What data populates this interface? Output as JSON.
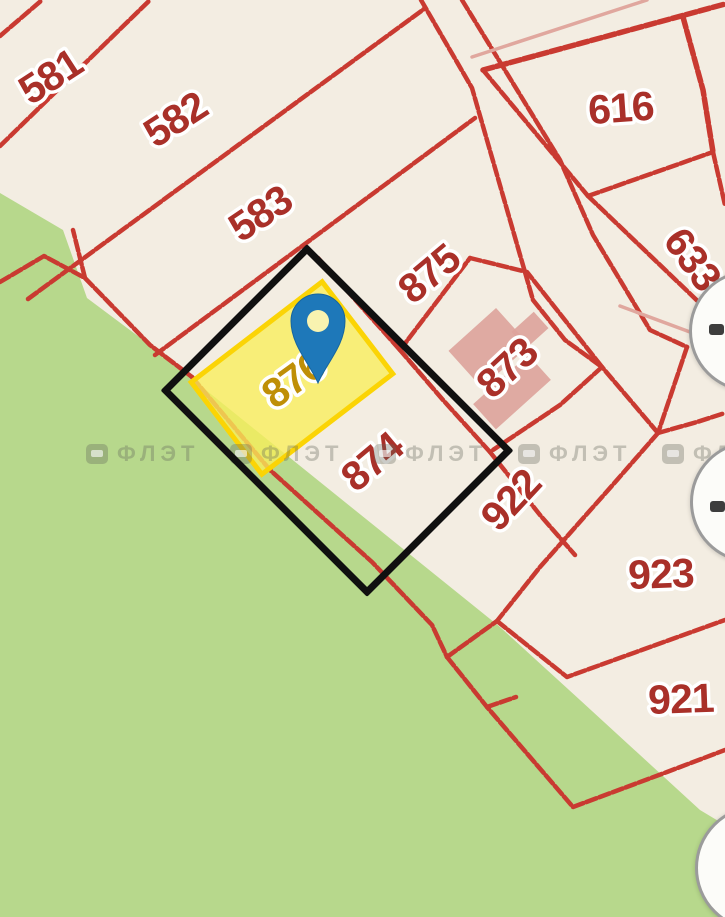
{
  "map": {
    "watermark_text": "ФЛЭТ",
    "selected": {
      "parcel_number": "876"
    },
    "parcels": [
      {
        "number": "581",
        "x": 52,
        "y": 79,
        "rotation": -33,
        "highlighted": false
      },
      {
        "number": "582",
        "x": 177,
        "y": 122,
        "rotation": -33,
        "highlighted": false
      },
      {
        "number": "583",
        "x": 262,
        "y": 216,
        "rotation": -34,
        "highlighted": false
      },
      {
        "number": "616",
        "x": 621,
        "y": 111,
        "rotation": -4,
        "highlighted": false
      },
      {
        "number": "633",
        "x": 690,
        "y": 261,
        "rotation": 54,
        "highlighted": false
      },
      {
        "number": "875",
        "x": 431,
        "y": 276,
        "rotation": -40,
        "highlighted": false
      },
      {
        "number": "873",
        "x": 509,
        "y": 370,
        "rotation": -43,
        "highlighted": false
      },
      {
        "number": "876",
        "x": 295,
        "y": 382,
        "rotation": -36,
        "highlighted": true
      },
      {
        "number": "874",
        "x": 374,
        "y": 464,
        "rotation": -40,
        "highlighted": false
      },
      {
        "number": "922",
        "x": 513,
        "y": 502,
        "rotation": -47,
        "highlighted": false
      },
      {
        "number": "923",
        "x": 661,
        "y": 577,
        "rotation": -2,
        "highlighted": false
      },
      {
        "number": "921",
        "x": 681,
        "y": 702,
        "rotation": -2,
        "highlighted": false
      }
    ],
    "controls": [
      {
        "icon": "dash-icon"
      },
      {
        "icon": "dash-icon"
      },
      {
        "icon": "blank"
      }
    ],
    "colors": {
      "background": "#f3ede2",
      "greenery": "#b7d88c",
      "boundary_red": "#c93a31",
      "label_red": "#a93029",
      "label_gold": "#bf8f06",
      "highlight_fill": "rgba(248,238,90,0.78)",
      "highlight_border": "#fbd405",
      "selection_black": "#101010",
      "pin_blue": "#1e78b9",
      "building_pink": "#dda49c",
      "faded_pink": "#e0a79e"
    }
  }
}
